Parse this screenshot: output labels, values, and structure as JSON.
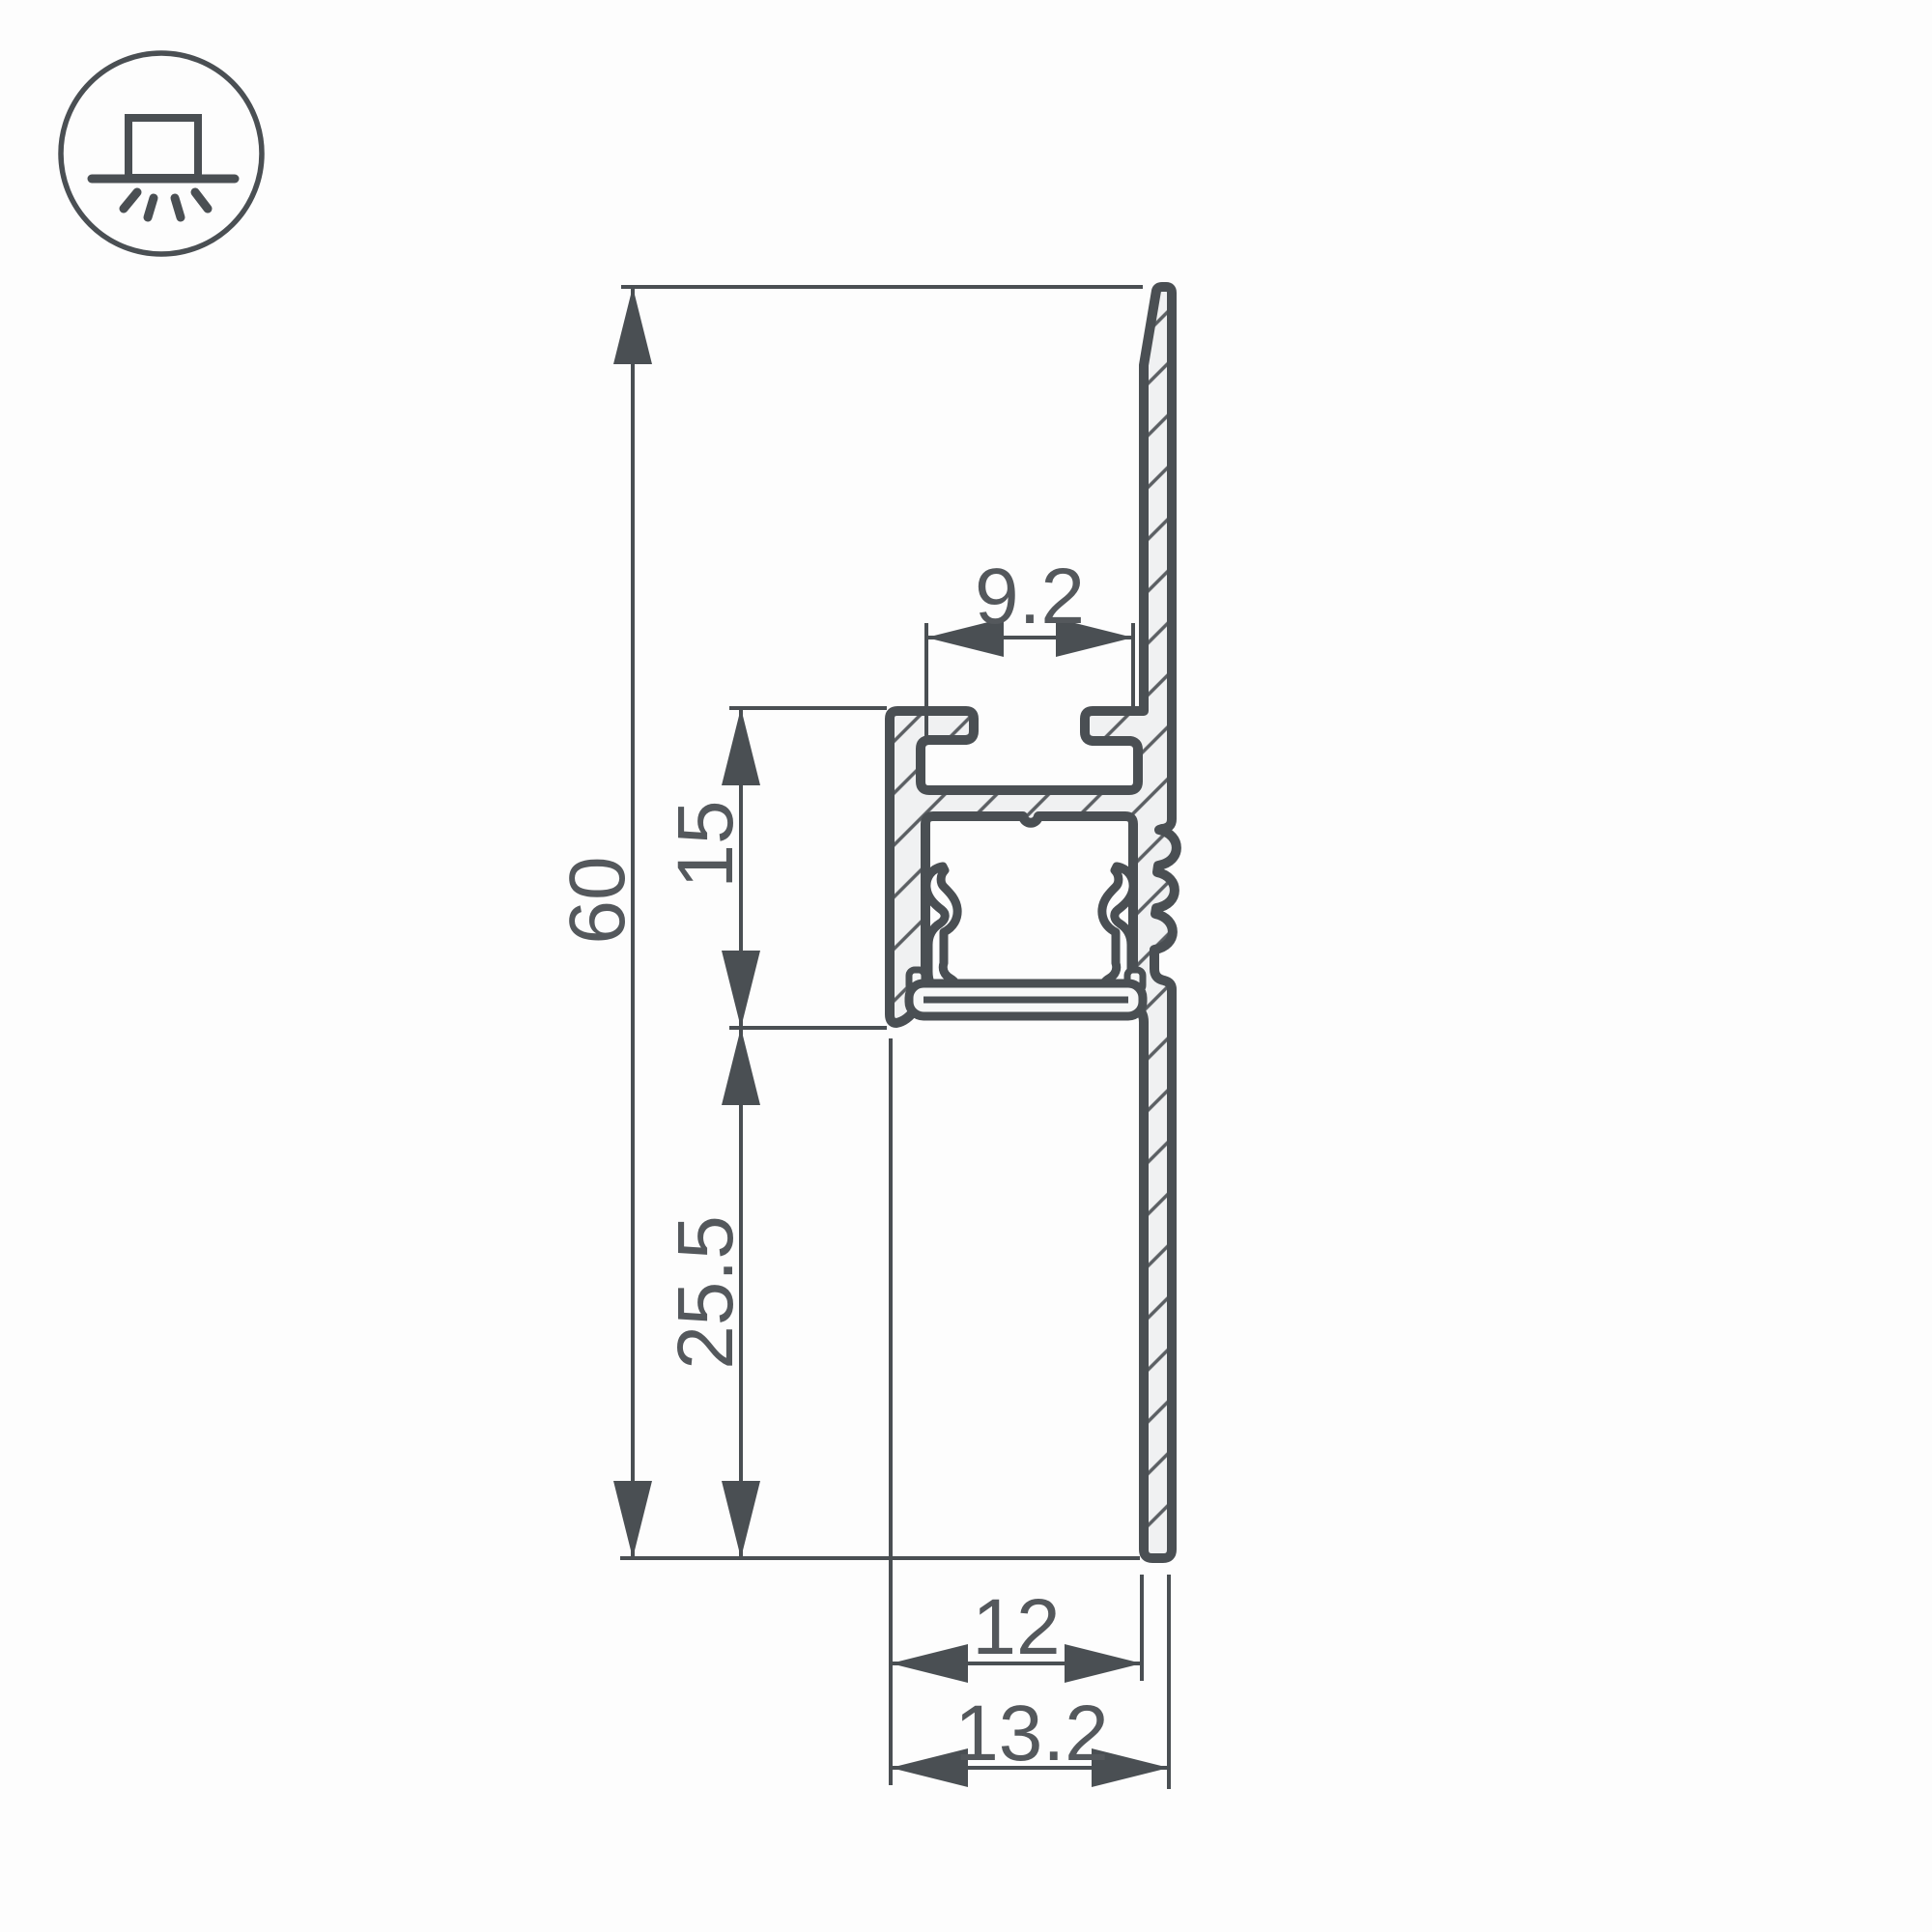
{
  "background": "#fdfdfd",
  "icon": {
    "name": "surface-mounted-light",
    "color": "#4a4f53"
  },
  "drawing": {
    "stroke": "#4a4f53",
    "fill": "#f0f1f2",
    "text_color": "#54585c",
    "dimensions": {
      "slot_width": "9.2",
      "channel_height": "15",
      "total_height": "60",
      "lower_section": "25.5",
      "base_width": "12",
      "overall_width": "13.2"
    }
  }
}
